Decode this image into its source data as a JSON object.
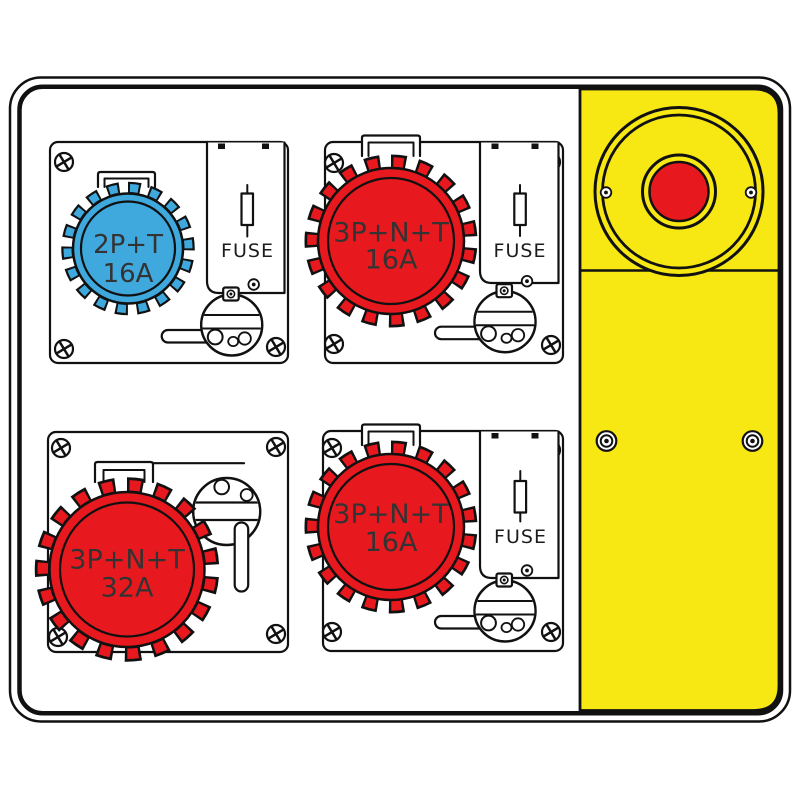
{
  "colors": {
    "red": "#e8191e",
    "blue": "#3fa8dc",
    "yellow": "#f7e713",
    "outline": "#111111",
    "label_text": "#333333"
  },
  "units": {
    "top_left": {
      "type": "2P+T",
      "rating": "16A",
      "fuse": "FUSE"
    },
    "top_right": {
      "type": "3P+N+T",
      "rating": "16A",
      "fuse": "FUSE"
    },
    "bottom_left": {
      "type": "3P+N+T",
      "rating": "32A"
    },
    "bottom_right": {
      "type": "3P+N+T",
      "rating": "16A",
      "fuse": "FUSE"
    }
  }
}
